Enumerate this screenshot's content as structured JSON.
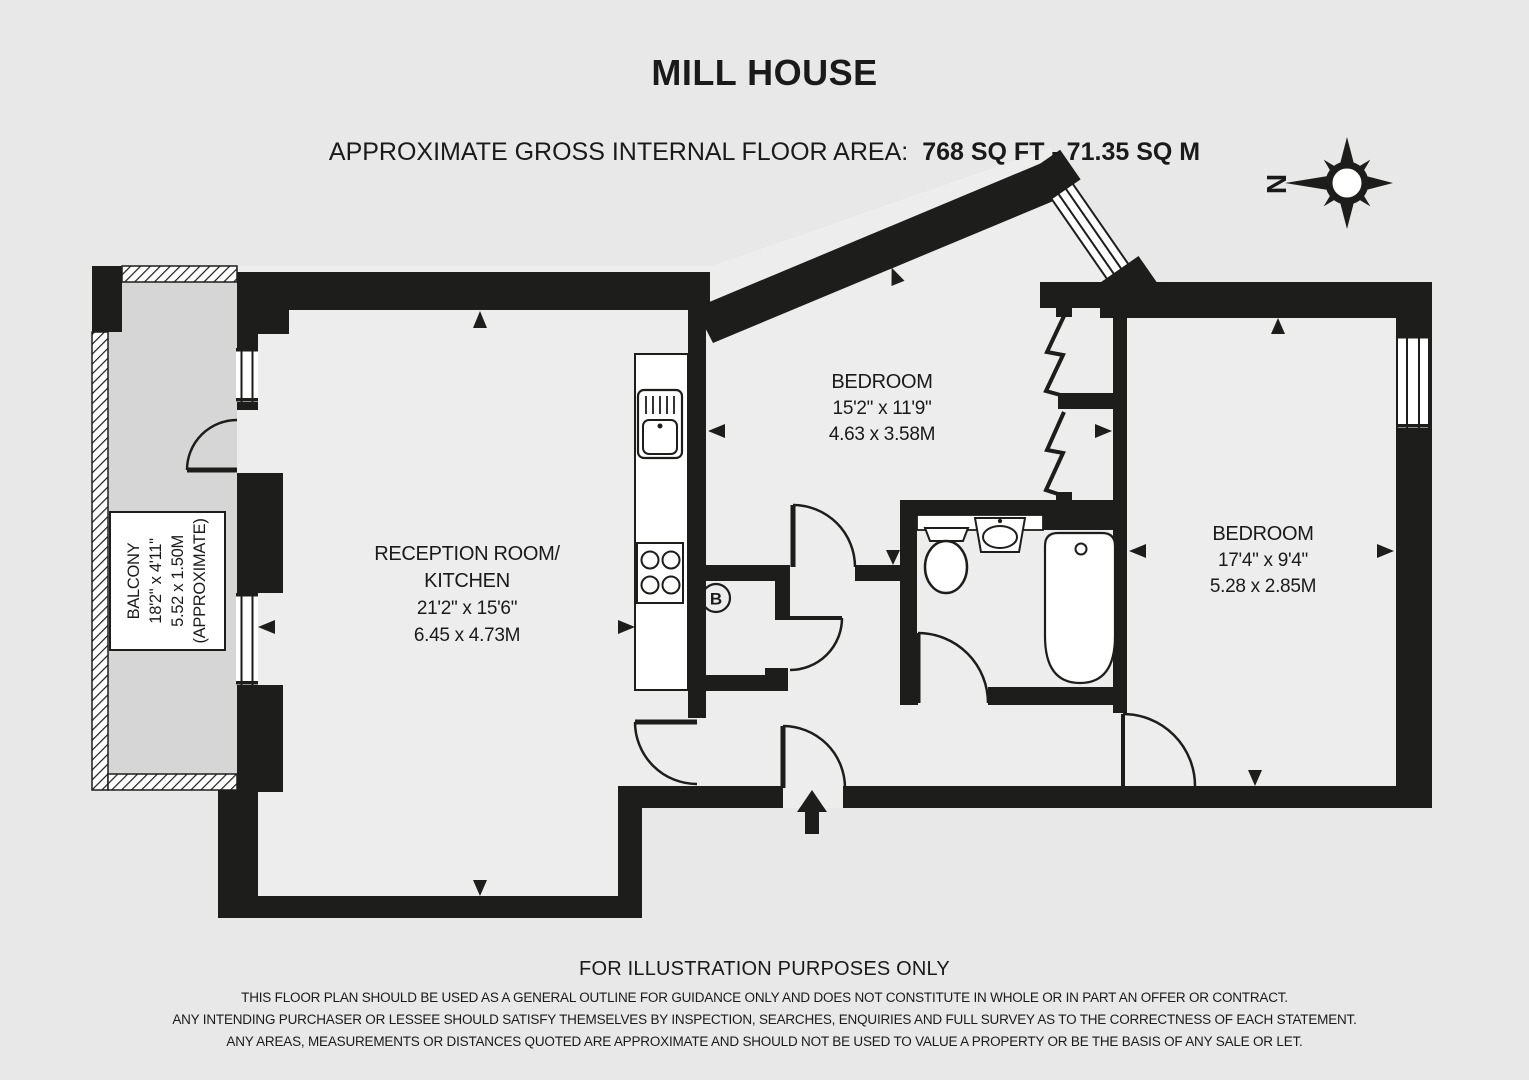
{
  "header": {
    "title": "MILL HOUSE",
    "area_label": "APPROXIMATE GROSS INTERNAL FLOOR AREA:",
    "area_value": "768 SQ FT - 71.35 SQ M"
  },
  "compass": {
    "north_label": "N"
  },
  "watermark": "barnard marcus",
  "rooms": {
    "reception": {
      "name_line1": "RECEPTION ROOM/",
      "name_line2": "KITCHEN",
      "dims_imperial": "21'2\" x 15'6\"",
      "dims_metric": "6.45 x 4.73M"
    },
    "bedroom1": {
      "name": "BEDROOM",
      "dims_imperial": "15'2\" x 11'9\"",
      "dims_metric": "4.63 x 3.58M"
    },
    "bedroom2": {
      "name": "BEDROOM",
      "dims_imperial": "17'4\" x 9'4\"",
      "dims_metric": "5.28 x 2.85M"
    },
    "balcony": {
      "name": "BALCONY",
      "dims_imperial": "18'2\" x 4'11\"",
      "dims_metric": "5.52 x 1.50M",
      "note": "(APPROXIMATE)"
    }
  },
  "labels": {
    "boiler": "B"
  },
  "footer": {
    "notice": "FOR ILLUSTRATION PURPOSES ONLY",
    "disclaimer_line1": "THIS FLOOR PLAN SHOULD BE USED AS A GENERAL OUTLINE FOR GUIDANCE ONLY AND DOES NOT CONSTITUTE IN WHOLE OR IN PART AN OFFER OR CONTRACT.",
    "disclaimer_line2": "ANY INTENDING PURCHASER OR LESSEE SHOULD SATISFY THEMSELVES BY INSPECTION, SEARCHES, ENQUIRIES AND FULL SURVEY AS TO THE CORRECTNESS OF EACH STATEMENT.",
    "disclaimer_line3": "ANY AREAS, MEASUREMENTS OR DISTANCES QUOTED ARE APPROXIMATE AND SHOULD NOT BE USED TO VALUE A PROPERTY OR BE THE BASIS OF ANY SALE OR LET."
  },
  "colors": {
    "wall": "#1d1d1b",
    "background": "#e8e8e8",
    "floor": "#ededed",
    "balcony_floor": "#d6d6d6"
  }
}
